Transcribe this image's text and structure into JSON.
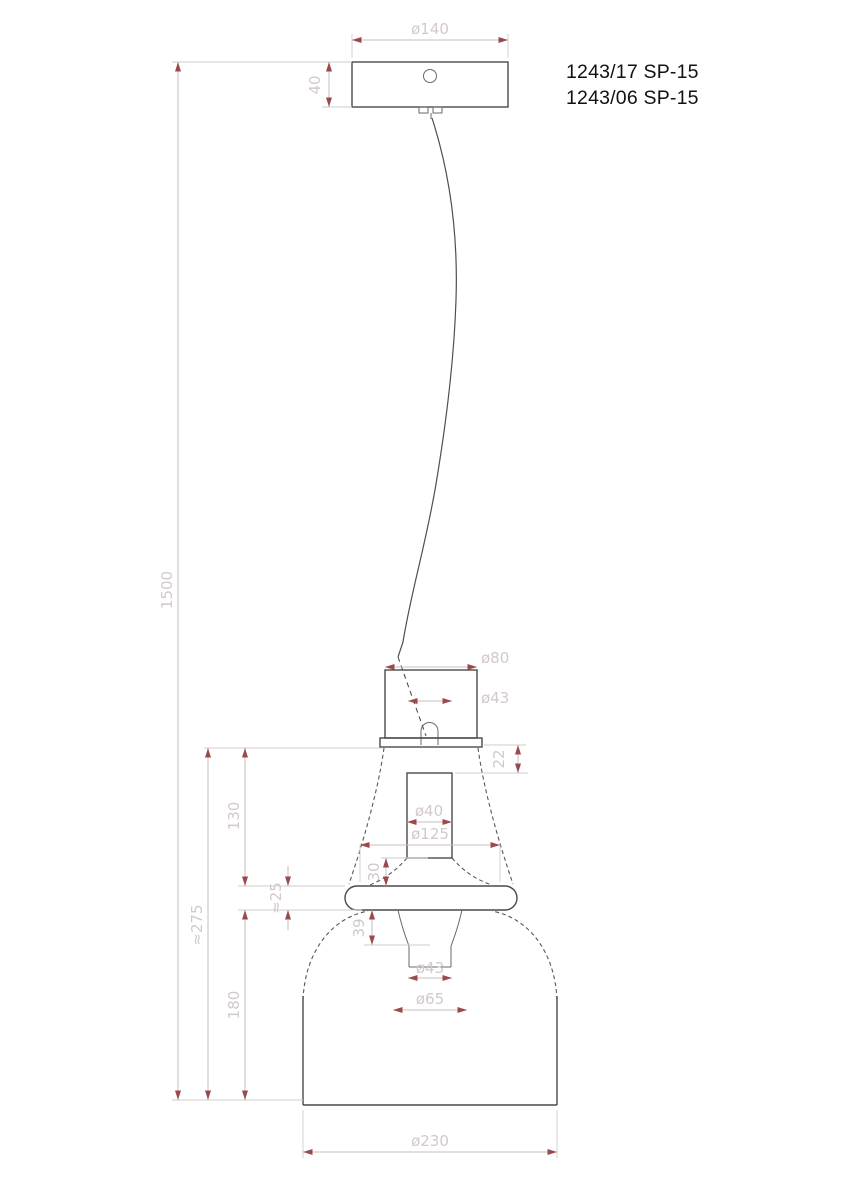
{
  "title": {
    "model_code_1": "1243/17 SP-15",
    "model_code_2": "1243/06 SP-15"
  },
  "dimensions": {
    "canopy_diameter": "ø140",
    "canopy_height": "40",
    "overall_height": "1500",
    "glass_assembly_height": "≈275",
    "upper_glass_height": "130",
    "ring_height": "≈25",
    "bell_height": "180",
    "neck_diameter": "ø80",
    "neck_inner_diameter": "ø43",
    "flange_to_socket_gap": "22",
    "socket_tube_diameter": "ø40",
    "shoulder_diameter": "ø125",
    "socket_inset_depth": "30",
    "nipple_depth": "39",
    "nipple_inner_diameter": "ø43",
    "nipple_outer_diameter": "ø65",
    "bell_diameter": "ø230"
  },
  "colors": {
    "background": "#ffffff",
    "outline": "#4a4a4a",
    "dimension_line": "#c9bdbd",
    "dimension_text": "#d2c9c9",
    "arrowhead": "#9a4a4a",
    "title_text": "#111111"
  }
}
